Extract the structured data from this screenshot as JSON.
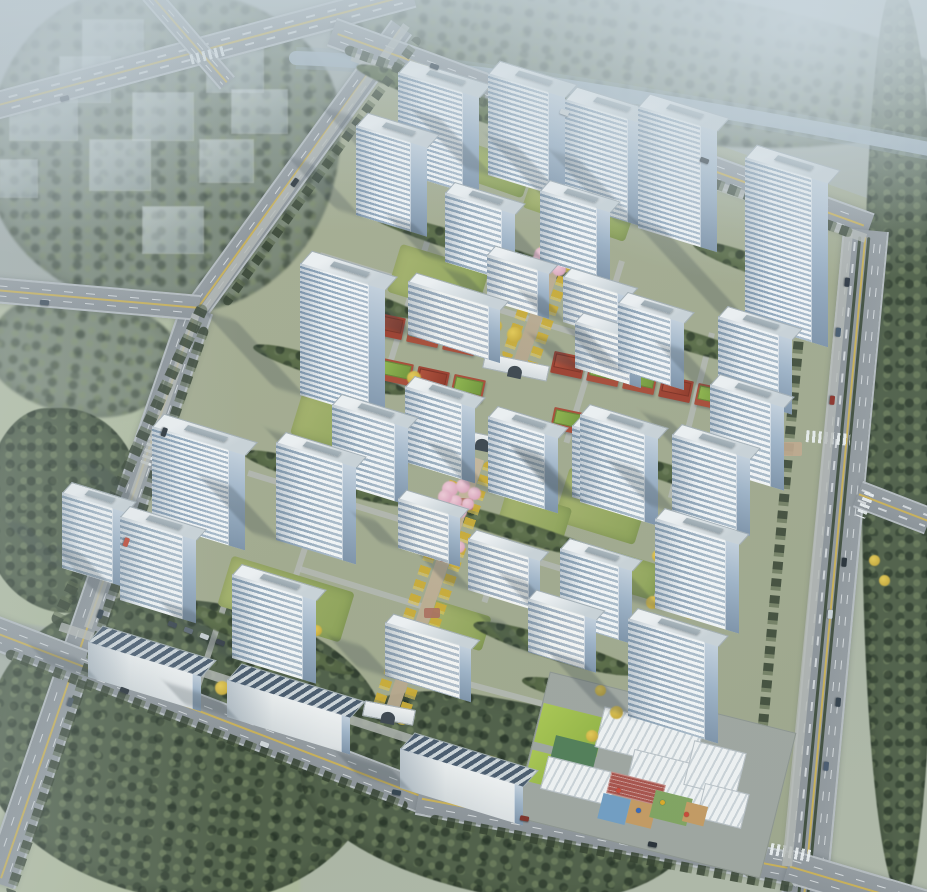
{
  "scene": {
    "canvas": {
      "w": 927,
      "h": 892
    },
    "palette": {
      "haze": "#c8d5dc",
      "river": "#a3b5c2",
      "asphalt": "#8f979c",
      "center_line_yellow": "#d2b44e",
      "facade_white": "#f5f8fa",
      "window_band_blue": "#90a7bd",
      "glass_side": "#7d93aa",
      "roof_gray": "#dfe5e8",
      "lawn_green": "#97ab5c",
      "meadow": "#b5c0a2",
      "tree_dark": "#4d5d45",
      "tree_inner": "#5e7148",
      "golden_tree": "#d2ac30",
      "blossom_pink": "#e5afc4",
      "shop_brick_red": "#a84832",
      "shop_green_roof": "#7fae3e",
      "kindergarten_track_red": "#a85048",
      "play_blue": "#6f9dc4",
      "play_orange": "#c59a60",
      "play_green": "#7fa45e"
    },
    "meadows": [
      [
        -40,
        300,
        240,
        330,
        8
      ],
      [
        -20,
        690,
        320,
        210,
        0
      ],
      [
        60,
        330,
        130,
        90,
        -10
      ]
    ],
    "site_polygon": "397px 30px, 878px 202px, 800px 864px, 420px 790px, 75px 661px, 198px 307px",
    "groves_outer": [
      [
        330,
        -12,
        620,
        150,
        7,
        2
      ],
      [
        -12,
        -12,
        352,
        325,
        0,
        2
      ],
      [
        -12,
        296,
        190,
        120,
        8,
        2
      ],
      [
        -16,
        408,
        155,
        205,
        0,
        0
      ],
      [
        -16,
        600,
        400,
        300,
        6,
        0
      ],
      [
        300,
        700,
        400,
        195,
        10,
        0
      ],
      [
        862,
        -10,
        75,
        910,
        0,
        0
      ]
    ],
    "ghosts": [
      [
        83,
        20,
        60,
        57
      ],
      [
        207,
        42,
        56,
        50
      ],
      [
        60,
        57,
        50,
        45
      ],
      [
        10,
        100,
        67,
        40
      ],
      [
        133,
        93,
        60,
        47
      ],
      [
        232,
        90,
        55,
        43
      ],
      [
        90,
        140,
        60,
        50
      ],
      [
        200,
        140,
        53,
        42
      ],
      [
        0,
        160,
        37,
        37
      ],
      [
        143,
        207,
        60,
        46
      ]
    ],
    "roads": [
      {
        "x": -20,
        "y": 108,
        "len": 448,
        "w": 24,
        "ang": -15,
        "major": 0
      },
      {
        "x": 150,
        "y": -8,
        "len": 118,
        "w": 16,
        "ang": 49,
        "major": 0
      },
      {
        "x": 197,
        "y": 307,
        "len": 348,
        "w": 22,
        "ang": -54,
        "major": 0
      },
      {
        "x": 197,
        "y": 307,
        "len": 608,
        "w": 30,
        "ang": 109,
        "major": 0
      },
      {
        "x": -6,
        "y": 288,
        "len": 206,
        "w": 22,
        "ang": 5,
        "major": 0
      },
      {
        "x": 332,
        "y": 30,
        "len": 572,
        "w": 26,
        "ang": 20,
        "major": 0
      },
      {
        "x": 866,
        "y": 228,
        "len": 674,
        "w": 42,
        "ang": 95.3,
        "major": 1
      },
      {
        "x": 858,
        "y": 492,
        "len": 76,
        "w": 24,
        "ang": 21,
        "major": 0
      },
      {
        "x": -12,
        "y": 628,
        "len": 474,
        "w": 30,
        "ang": 21,
        "major": 0
      },
      {
        "x": 418,
        "y": 796,
        "len": 384,
        "w": 30,
        "ang": 10.7,
        "major": 0
      },
      {
        "x": 788,
        "y": 864,
        "len": 150,
        "w": 30,
        "ang": 16.5,
        "major": 0
      }
    ],
    "crosswalks": [
      [
        806,
        432,
        44,
        12,
        5
      ],
      [
        764,
        846,
        48,
        12,
        10
      ],
      [
        582,
        132,
        40,
        11,
        20
      ],
      [
        132,
        440,
        40,
        11,
        109
      ],
      [
        190,
        50,
        36,
        10,
        -15
      ],
      [
        852,
        500,
        26,
        10,
        111
      ]
    ],
    "paths": [
      [
        352,
        52,
        545,
        9,
        19.5
      ],
      [
        848,
        228,
        636,
        10,
        95.5
      ],
      [
        60,
        622,
        742,
        9,
        17.8
      ],
      [
        196,
        310,
        332,
        8,
        109
      ],
      [
        202,
        308,
        352,
        8,
        -54.5
      ],
      [
        320,
        252,
        300,
        6,
        17
      ],
      [
        248,
        470,
        430,
        6,
        17
      ],
      [
        300,
        566,
        380,
        6,
        17
      ],
      [
        356,
        118,
        430,
        6,
        19.5
      ],
      [
        420,
        668,
        280,
        6,
        15
      ],
      [
        428,
        236,
        210,
        6,
        107
      ],
      [
        622,
        258,
        190,
        6,
        107
      ],
      [
        712,
        330,
        170,
        6,
        104
      ],
      [
        540,
        428,
        180,
        6,
        108
      ],
      [
        330,
        468,
        170,
        6,
        108
      ],
      [
        238,
        560,
        150,
        6,
        108
      ]
    ],
    "lawns": [
      [
        448,
        150,
        82,
        36,
        19
      ],
      [
        528,
        172,
        108,
        54,
        19
      ],
      [
        392,
        256,
        92,
        50,
        17
      ],
      [
        295,
        400,
        76,
        46,
        17
      ],
      [
        560,
        478,
        84,
        56,
        17
      ],
      [
        500,
        498,
        68,
        40,
        17
      ],
      [
        222,
        573,
        128,
        52,
        17
      ],
      [
        595,
        556,
        64,
        36,
        17
      ],
      [
        418,
        606,
        70,
        36,
        17
      ]
    ],
    "groves_inner": [
      [
        350,
        95,
        250,
        24,
        19
      ],
      [
        368,
        238,
        220,
        20,
        17
      ],
      [
        250,
        360,
        160,
        20,
        17
      ],
      [
        240,
        468,
        180,
        22,
        17
      ],
      [
        420,
        520,
        190,
        20,
        17
      ],
      [
        470,
        638,
        170,
        22,
        17
      ],
      [
        160,
        628,
        200,
        20,
        21
      ],
      [
        600,
        330,
        170,
        20,
        17
      ],
      [
        610,
        468,
        140,
        18,
        17
      ],
      [
        690,
        255,
        130,
        20,
        19
      ],
      [
        520,
        688,
        150,
        20,
        14
      ],
      [
        300,
        290,
        120,
        18,
        17
      ]
    ],
    "tree_rows": [
      [
        345,
        44,
        540,
        10,
        20
      ],
      [
        808,
        235,
        640,
        10,
        95.3
      ],
      [
        6,
        648,
        430,
        10,
        21
      ],
      [
        430,
        814,
        370,
        10,
        10.7
      ],
      [
        205,
        322,
        600,
        10,
        109
      ],
      [
        225,
        300,
        330,
        9,
        -54
      ],
      [
        55,
        618,
        352,
        12,
        -65
      ]
    ],
    "axes": [
      {
        "x": 586,
        "y": 168,
        "len": 201,
        "w": 13,
        "ang": 109.4
      },
      {
        "x": 478,
        "y": 452,
        "len": 278,
        "w": 13,
        "ang": 108.9
      }
    ],
    "plazas_tan": [
      [
        770,
        442,
        32,
        14
      ],
      [
        586,
        140,
        26,
        16
      ]
    ],
    "plazas_red": [
      [
        455,
        498,
        18,
        12
      ],
      [
        440,
        550,
        18,
        12
      ],
      [
        424,
        608,
        16,
        10
      ],
      [
        412,
        652,
        16,
        10
      ]
    ],
    "shops": [
      [
        352,
        318,
        "sg"
      ],
      [
        388,
        326,
        "sr"
      ],
      [
        424,
        334,
        "sg"
      ],
      [
        460,
        342,
        "sg"
      ],
      [
        568,
        365,
        "sr"
      ],
      [
        604,
        373,
        "sg"
      ],
      [
        640,
        381,
        "sg"
      ],
      [
        676,
        389,
        "sr"
      ],
      [
        712,
        397,
        "sg"
      ],
      [
        746,
        405,
        "sg"
      ],
      [
        360,
        364,
        "sg"
      ],
      [
        396,
        372,
        "sg"
      ],
      [
        432,
        380,
        "sr"
      ],
      [
        468,
        388,
        "sg"
      ],
      [
        568,
        421,
        "sg"
      ],
      [
        604,
        429,
        "sr"
      ],
      [
        640,
        437,
        "sg"
      ]
    ],
    "gates": [
      [
        515,
        366,
        64,
        14,
        12
      ],
      [
        482,
        440,
        58,
        12,
        12
      ],
      [
        388,
        712,
        50,
        14,
        11
      ]
    ],
    "kindergarten": [
      [
        528,
        700,
        252,
        148,
        "kpad"
      ],
      [
        538,
        710,
        64,
        40,
        "klwn"
      ],
      [
        528,
        754,
        40,
        32,
        "klwn"
      ],
      [
        552,
        740,
        44,
        28,
        "kcrt"
      ],
      [
        543,
        764,
        70,
        32,
        "kwht"
      ],
      [
        598,
        718,
        100,
        40,
        "kwht"
      ],
      [
        628,
        760,
        95,
        40,
        "kwht"
      ],
      [
        688,
        746,
        52,
        44,
        "kwht"
      ],
      [
        700,
        788,
        44,
        34,
        "kwht"
      ],
      [
        608,
        778,
        56,
        22,
        "ktrk"
      ],
      [
        600,
        796,
        28,
        26,
        "kpb"
      ],
      [
        628,
        802,
        26,
        24,
        "kpo"
      ],
      [
        652,
        794,
        38,
        28,
        "kpg"
      ],
      [
        684,
        804,
        22,
        20,
        "kpo"
      ]
    ],
    "kdots": [
      [
        616,
        788,
        "#cc4433"
      ],
      [
        636,
        808,
        "#3366bb"
      ],
      [
        660,
        800,
        "#ddaa22"
      ],
      [
        684,
        812,
        "#cc4433"
      ]
    ],
    "pinks": [
      [
        542,
        255
      ],
      [
        556,
        249
      ],
      [
        566,
        259
      ],
      [
        547,
        267
      ],
      [
        559,
        269
      ],
      [
        537,
        261
      ],
      [
        450,
        489
      ],
      [
        463,
        486
      ],
      [
        474,
        493
      ],
      [
        455,
        501
      ],
      [
        468,
        504
      ],
      [
        445,
        497
      ],
      [
        460,
        511
      ],
      [
        437,
        541
      ],
      [
        449,
        539
      ],
      [
        459,
        547
      ],
      [
        441,
        553
      ],
      [
        453,
        555
      ]
    ],
    "yellows": [
      [
        352,
        430
      ],
      [
        366,
        446
      ],
      [
        334,
        452
      ],
      [
        476,
        318
      ],
      [
        496,
        326
      ],
      [
        514,
        334
      ],
      [
        600,
        345
      ],
      [
        622,
        353
      ],
      [
        642,
        361
      ],
      [
        658,
        556
      ],
      [
        674,
        580
      ],
      [
        652,
        602
      ],
      [
        690,
        612
      ],
      [
        600,
        690
      ],
      [
        616,
        712
      ],
      [
        592,
        736
      ],
      [
        640,
        162
      ],
      [
        658,
        180
      ],
      [
        428,
        390
      ],
      [
        414,
        378
      ],
      [
        300,
        612
      ],
      [
        316,
        630
      ],
      [
        222,
        688
      ],
      [
        240,
        702
      ],
      [
        150,
        662
      ],
      [
        490,
        762
      ],
      [
        506,
        774
      ],
      [
        752,
        332
      ],
      [
        766,
        350
      ],
      [
        874,
        560
      ],
      [
        884,
        580
      ]
    ],
    "buildings": [
      [
        398,
        172,
        64,
        100,
        "t"
      ],
      [
        356,
        215,
        54,
        90,
        "t"
      ],
      [
        488,
        175,
        60,
        102,
        "t"
      ],
      [
        565,
        203,
        62,
        104,
        "t"
      ],
      [
        638,
        228,
        62,
        122,
        "t"
      ],
      [
        745,
        322,
        66,
        165,
        "t"
      ],
      [
        718,
        392,
        60,
        76,
        "m"
      ],
      [
        710,
        468,
        60,
        84,
        "m"
      ],
      [
        672,
        512,
        64,
        78,
        "m"
      ],
      [
        655,
        608,
        70,
        90,
        "m"
      ],
      [
        628,
        716,
        76,
        98,
        "m"
      ],
      [
        618,
        370,
        52,
        68,
        "m"
      ],
      [
        572,
        497,
        58,
        72,
        "m"
      ],
      [
        560,
        622,
        58,
        74,
        "m"
      ],
      [
        445,
        262,
        56,
        70,
        "m"
      ],
      [
        540,
        260,
        56,
        70,
        "m"
      ],
      [
        300,
        395,
        68,
        132,
        "t"
      ],
      [
        332,
        482,
        62,
        78,
        "m"
      ],
      [
        152,
        522,
        76,
        96,
        "t"
      ],
      [
        276,
        540,
        66,
        98,
        "m"
      ],
      [
        62,
        568,
        50,
        76,
        "m"
      ],
      [
        120,
        600,
        62,
        84,
        "m"
      ],
      [
        232,
        658,
        70,
        84,
        "m"
      ],
      [
        408,
        335,
        80,
        54,
        "l"
      ],
      [
        487,
        300,
        50,
        46,
        "l"
      ],
      [
        563,
        322,
        54,
        46,
        "l"
      ],
      [
        575,
        368,
        54,
        47,
        "l"
      ],
      [
        398,
        548,
        50,
        50,
        "l"
      ],
      [
        468,
        590,
        60,
        52,
        "l"
      ],
      [
        385,
        676,
        74,
        54,
        "l"
      ],
      [
        528,
        652,
        56,
        54,
        "l"
      ],
      [
        405,
        462,
        56,
        76,
        "m"
      ],
      [
        488,
        492,
        56,
        76,
        "m"
      ],
      [
        580,
        502,
        64,
        88,
        "m"
      ],
      [
        88,
        677,
        104,
        36,
        "g"
      ],
      [
        227,
        717,
        114,
        38,
        "g"
      ],
      [
        400,
        788,
        114,
        40,
        "g"
      ]
    ],
    "cars": [
      [
        843,
        280,
        95,
        "#2b3440"
      ],
      [
        834,
        330,
        95,
        "#44586c"
      ],
      [
        828,
        398,
        95,
        "#8c2f26"
      ],
      [
        840,
        560,
        95,
        "#232c34"
      ],
      [
        826,
        612,
        95,
        "#ccd4d9"
      ],
      [
        834,
        700,
        95,
        "#2f3c48"
      ],
      [
        822,
        764,
        95,
        "#47586d"
      ],
      [
        160,
        430,
        109,
        "#232c34"
      ],
      [
        122,
        540,
        109,
        "#c24733"
      ],
      [
        96,
        612,
        109,
        "#2c3a45"
      ],
      [
        66,
        700,
        109,
        "#44525e"
      ],
      [
        120,
        688,
        21,
        "#222b33"
      ],
      [
        260,
        742,
        21,
        "#d0d6d9"
      ],
      [
        392,
        790,
        11,
        "#30404c"
      ],
      [
        520,
        816,
        11,
        "#7d2d24"
      ],
      [
        648,
        842,
        11,
        "#232b33"
      ],
      [
        430,
        64,
        20,
        "#2c3a46"
      ],
      [
        560,
        110,
        20,
        "#cfd5d8"
      ],
      [
        700,
        158,
        20,
        "#222b33"
      ],
      [
        60,
        96,
        -15,
        "#333c4a"
      ],
      [
        290,
        180,
        -54,
        "#232c34"
      ],
      [
        40,
        300,
        5,
        "#3a4856"
      ],
      [
        168,
        622,
        21,
        "#38424c"
      ],
      [
        184,
        628,
        21,
        "#5a6570"
      ],
      [
        200,
        634,
        21,
        "#c8ced3"
      ],
      [
        216,
        640,
        21,
        "#333b45"
      ]
    ],
    "river": {
      "path": "M296,58 C420,62 560,84 700,108 C790,123 860,136 934,150",
      "color": "#a3b5c2"
    }
  }
}
